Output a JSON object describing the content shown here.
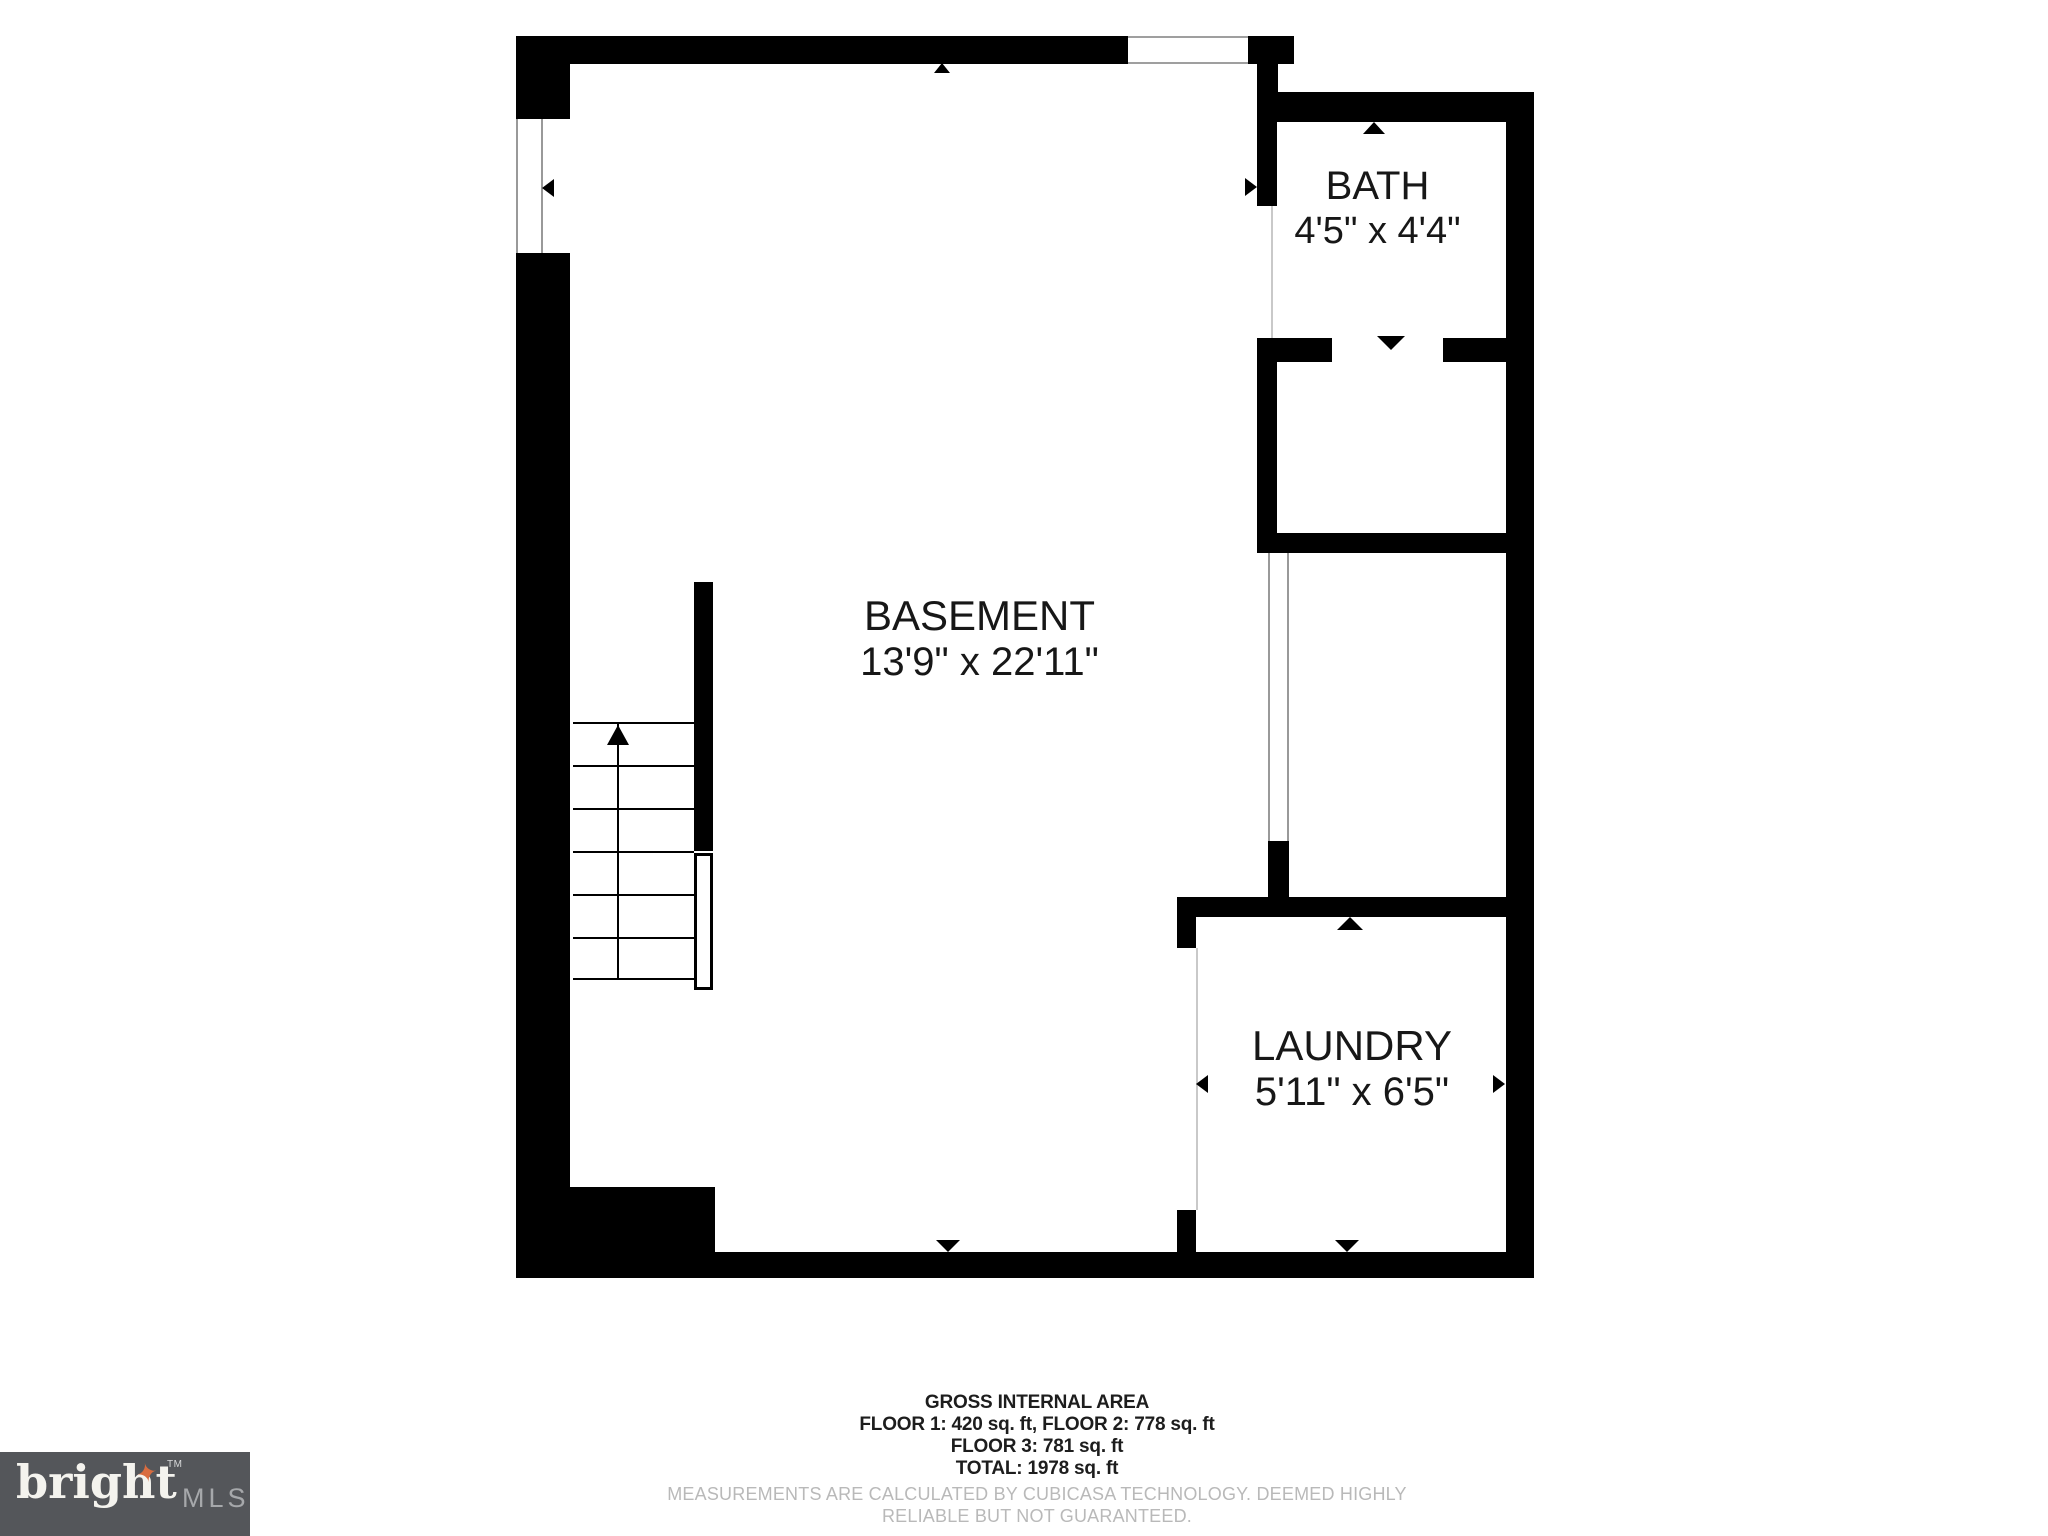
{
  "floorplan": {
    "rooms": [
      {
        "id": "basement",
        "name": "BASEMENT",
        "dimensions": "13'9\" x 22'11\""
      },
      {
        "id": "bath",
        "name": "BATH",
        "dimensions": "4'5\" x 4'4\""
      },
      {
        "id": "laundry",
        "name": "LAUNDRY",
        "dimensions": "5'11\" x 6'5\""
      }
    ],
    "stairs": {
      "steps": 6,
      "direction": "up",
      "icon": "stairs-up-arrow-icon"
    },
    "door_arrow_icons": [
      "arrow-up-icon",
      "arrow-down-icon",
      "arrow-left-icon",
      "arrow-right-icon"
    ],
    "wall_color": "#000000",
    "background_color": "#ffffff",
    "opening_line_color": "#999999"
  },
  "footer": {
    "title": "GROSS INTERNAL AREA",
    "areas_line1": "FLOOR 1: 420 sq. ft, FLOOR 2: 778 sq. ft",
    "areas_line2": "FLOOR 3: 781 sq. ft",
    "total_line": "TOTAL: 1978 sq. ft",
    "disclaimer": "MEASUREMENTS ARE CALCULATED BY CUBICASA TECHNOLOGY. DEEMED HIGHLY RELIABLE BUT NOT GUARANTEED."
  },
  "logo": {
    "brand": "bright",
    "suffix": "MLS",
    "trademark": "TM",
    "star_icon": "sparkle-star-icon",
    "colors": {
      "background": "#54565A",
      "brand_text": "#F4F3EE",
      "suffix_text": "#A6A8AB",
      "star": "#D96C3F"
    }
  }
}
